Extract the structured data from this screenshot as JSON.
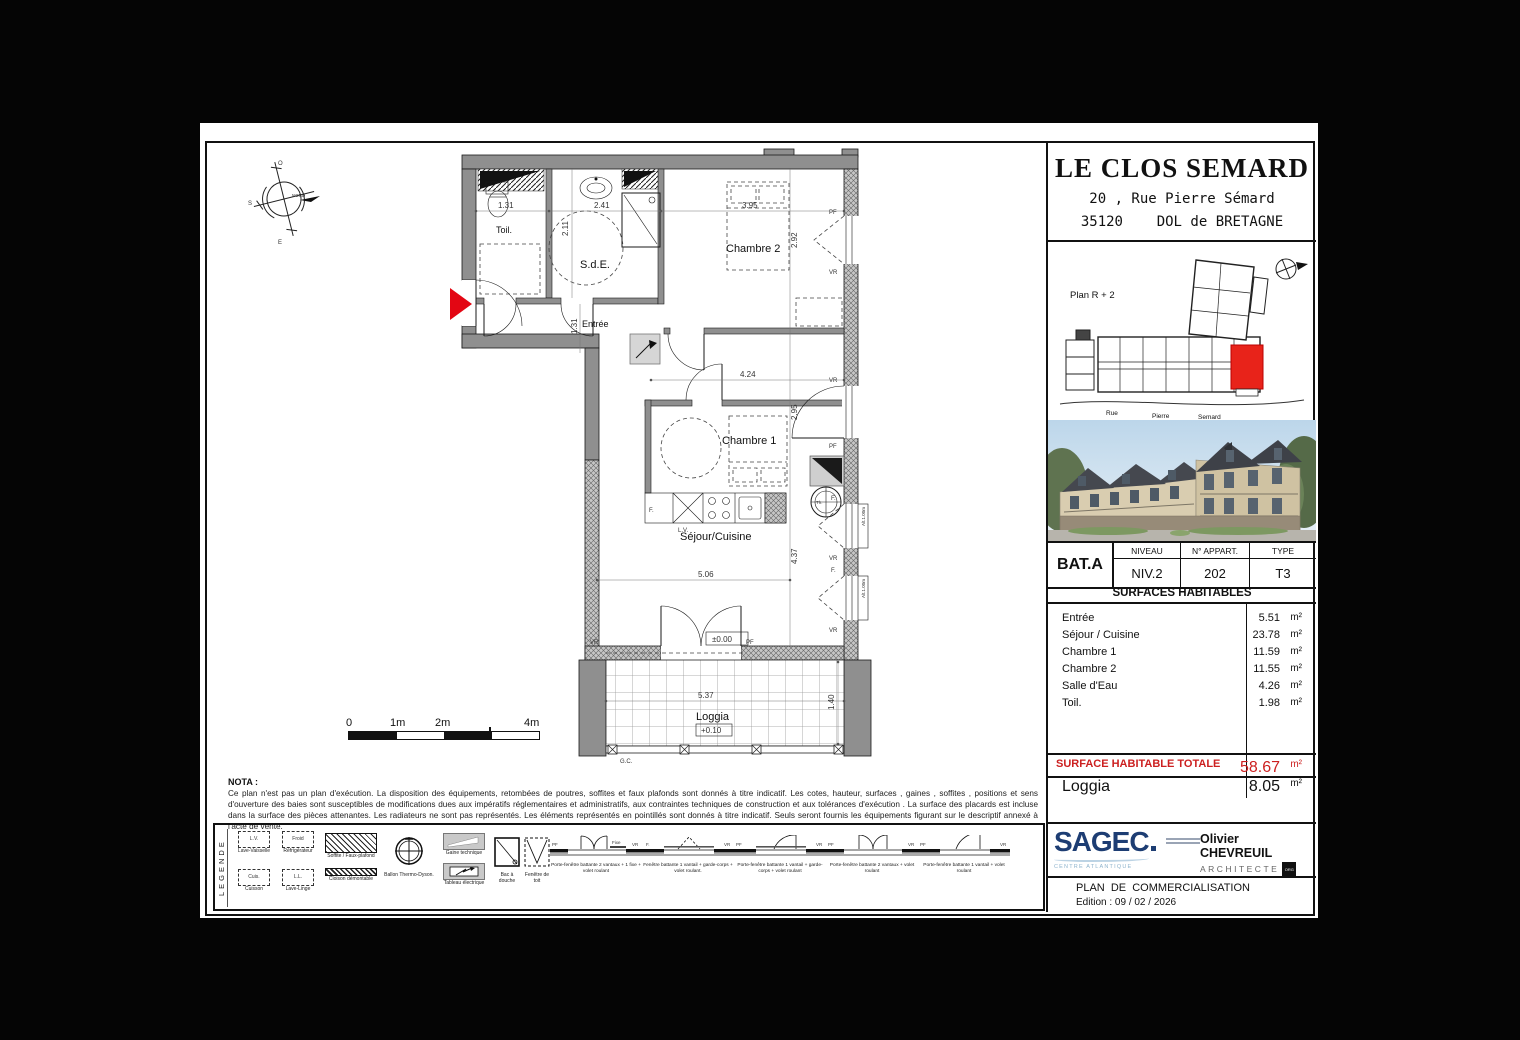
{
  "title_block": {
    "project": "LE CLOS SEMARD",
    "address1": "20 , Rue Pierre Sémard",
    "address2": "35120    DOL de BRETAGNE"
  },
  "site_plan": {
    "label": "Plan R + 2",
    "street_words": [
      "Rue",
      "Pierre",
      "Semard"
    ]
  },
  "unit_table": {
    "bat": "BAT.A",
    "cols": [
      {
        "header": "NIVEAU",
        "value": "NIV.2"
      },
      {
        "header": "N° APPART.",
        "value": "202"
      },
      {
        "header": "TYPE",
        "value": "T3"
      }
    ]
  },
  "surfaces": {
    "title": "SURFACES  HABITABLES",
    "unit": "m²",
    "rooms": [
      {
        "name": "Entrée",
        "area": "5.51"
      },
      {
        "name": "Séjour / Cuisine",
        "area": "23.78"
      },
      {
        "name": "Chambre 1",
        "area": "11.59"
      },
      {
        "name": "Chambre 2",
        "area": "11.55"
      },
      {
        "name": "Salle d'Eau",
        "area": "4.26"
      },
      {
        "name": "Toil.",
        "area": "1.98"
      }
    ],
    "total_label": "SURFACE HABITABLE TOTALE",
    "total_area": "58.67",
    "annex_label": "Loggia",
    "annex_area": "8.05"
  },
  "plan": {
    "rooms": {
      "toil": "Toil.",
      "sde": "S.d.E.",
      "entree": "Entrée",
      "chambre2": "Chambre 2",
      "chambre1": "Chambre 1",
      "sejour": "Séjour/Cuisine",
      "loggia": "Loggia"
    },
    "dims": {
      "toil_w": "1.31",
      "sde_h": "2.11",
      "sde_w": "2.41",
      "ch2_w": "3.95",
      "ch2_h": "2.92",
      "entree_h": "1.31",
      "ch1_w": "4.24",
      "ch1_h": "2.95",
      "sej_w": "5.06",
      "sej_h": "4.37",
      "log_w": "5.37",
      "log_h": "1.40"
    },
    "levels": {
      "sejour": "±0.00",
      "loggia": "+0.10"
    },
    "tags": {
      "vr": "VR",
      "pf": "PF",
      "f": "F.",
      "lv": "L.V.",
      "gc": "G.C.",
      "alt": "Alt.1.00m",
      "th": "Th.",
      "fixe": "Fixe"
    },
    "north": "NORD",
    "compass": {
      "top": "O",
      "left": "S",
      "bottom": "E"
    },
    "scale": [
      "0",
      "1m",
      "2m",
      "4m"
    ]
  },
  "nota": {
    "title": "NOTA :",
    "text": "Ce plan n'est pas un plan d'exécution. La disposition des équipements, retombées de poutres, soffites et faux plafonds sont donnés à titre indicatif. Les cotes, hauteur, surfaces , gaines , soffites , positions et sens d'ouverture des baies sont susceptibles de modifications dues aux impératifs réglementaires et administratifs, aux contraintes techniques de construction et aux tolérances d'exécution . La surface des placards est incluse dans la surface des pièces attenantes. Les radiateurs ne sont pas représentés. Les éléments représentés en pointillés sont donnés à titre indicatif. Seuls seront fournis les équipements figurant sur le descriptif annexé à l'acte de vente."
  },
  "legend": {
    "title": "LEGENDE",
    "appliances": [
      {
        "abbr": "L.V.",
        "label": "Lave-Vaisselle"
      },
      {
        "abbr": "Froid",
        "label": "Réfrigérateur"
      },
      {
        "abbr": "Cuis.",
        "label": "Cuisson"
      },
      {
        "abbr": "L.L.",
        "label": "Lave-Linge"
      }
    ],
    "items": [
      {
        "label": "Soffite / Faux-plafond"
      },
      {
        "label": "Cloison démontable"
      },
      {
        "label": "Ballon Thermo-Dyson."
      },
      {
        "label": "Gaine technique"
      },
      {
        "label": "Tableau électrique"
      },
      {
        "label": "Bac à douche"
      },
      {
        "label": "Fenêtre de toit"
      }
    ],
    "windows": [
      "Porte-fenêtre battante 2 vantaux + 1 fixe + volet roulant",
      "Fenêtre battante 1 vantail + garde-corps + volet roulant.",
      "Porte-fenêtre battante 1 vantail + garde-corps + volet roulant",
      "Porte-fenêtre battante 2 vantaux + volet roulant",
      "Porte-fenêtre battante 1 vantail + volet roulant"
    ]
  },
  "footer": {
    "developer": "SAGEC",
    "developer_region": "CENTRE ATLANTIQUE",
    "architect": "Olivier CHEVREUIL",
    "architect_title": "ARCHITECTE",
    "architect_org": "ORG",
    "doc_title": "PLAN  DE  COMMERCIALISATION",
    "edition": "Edition : 09 / 02 / 2026"
  },
  "colors": {
    "accent_red": "#e30613",
    "wall_gray": "#8f8f8f",
    "sagec_blue": "#1d3d73",
    "region_blue": "#8fb4cd"
  }
}
